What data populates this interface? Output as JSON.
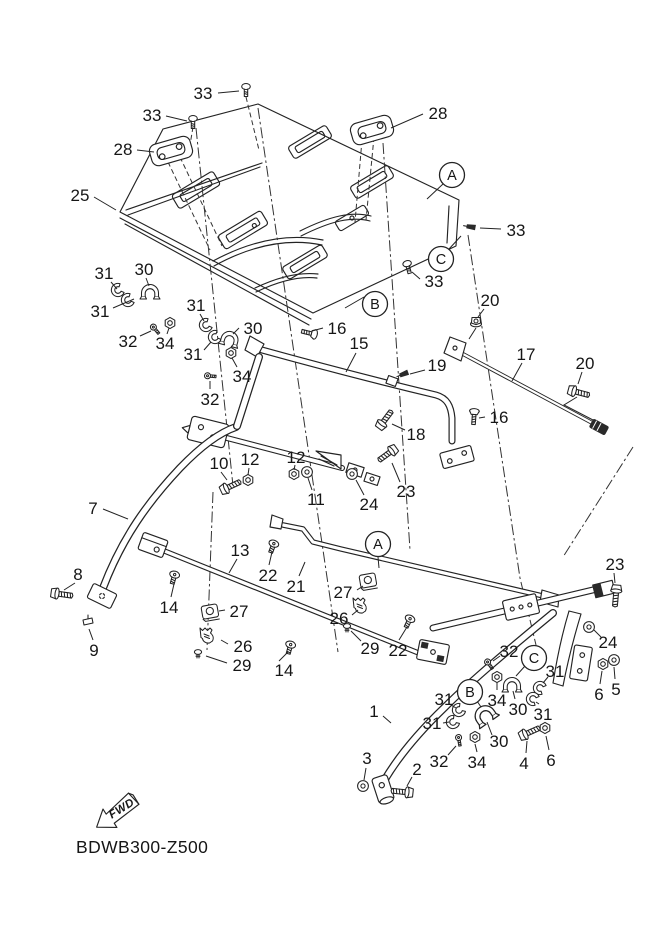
{
  "meta": {
    "code": "BDWB300-Z500",
    "fwd_label": "FWD"
  },
  "colors": {
    "line": "#232323",
    "background": "#ffffff"
  },
  "labels": [
    {
      "t": "33",
      "x": 203,
      "y": 93,
      "l": [
        218,
        93,
        239,
        91
      ]
    },
    {
      "t": "33",
      "x": 152,
      "y": 115,
      "l": [
        166,
        116,
        187,
        121
      ]
    },
    {
      "t": "28",
      "x": 123,
      "y": 149,
      "l": [
        137,
        150,
        154,
        152
      ]
    },
    {
      "t": "25",
      "x": 80,
      "y": 195,
      "l": [
        94,
        197,
        116,
        210
      ]
    },
    {
      "t": "28",
      "x": 438,
      "y": 113,
      "l": [
        423,
        114,
        391,
        128
      ]
    },
    {
      "t": "A",
      "x": 452,
      "y": 175,
      "c": true,
      "l": [
        443,
        184,
        427,
        199
      ]
    },
    {
      "t": "33",
      "x": 516,
      "y": 230,
      "l": [
        501,
        229,
        480,
        228
      ]
    },
    {
      "t": "C",
      "x": 441,
      "y": 259,
      "c": true,
      "l": [
        449,
        249,
        461,
        236
      ]
    },
    {
      "t": "33",
      "x": 434,
      "y": 281,
      "l": [
        420,
        279,
        412,
        272
      ]
    },
    {
      "t": "B",
      "x": 375,
      "y": 304,
      "c": true,
      "l": [
        364,
        297,
        345,
        308
      ]
    },
    {
      "t": "20",
      "x": 490,
      "y": 300,
      "l": [
        484,
        309,
        478,
        317
      ]
    },
    {
      "t": "16",
      "x": 337,
      "y": 328,
      "l": [
        323,
        328,
        312,
        331
      ]
    },
    {
      "t": "15",
      "x": 359,
      "y": 343,
      "l": [
        356,
        353,
        346,
        372
      ]
    },
    {
      "t": "17",
      "x": 526,
      "y": 354,
      "l": [
        522,
        363,
        512,
        381
      ]
    },
    {
      "t": "20",
      "x": 585,
      "y": 363,
      "l": [
        582,
        372,
        578,
        384
      ]
    },
    {
      "t": "19",
      "x": 437,
      "y": 365,
      "l": [
        425,
        370,
        410,
        374
      ]
    },
    {
      "t": "18",
      "x": 416,
      "y": 434,
      "l": [
        405,
        430,
        392,
        424
      ]
    },
    {
      "t": "16",
      "x": 499,
      "y": 417,
      "l": [
        485,
        417,
        479,
        418
      ]
    },
    {
      "t": "31",
      "x": 104,
      "y": 273,
      "l": [
        111,
        282,
        117,
        289
      ]
    },
    {
      "t": "30",
      "x": 144,
      "y": 269,
      "l": [
        146,
        278,
        149,
        286
      ]
    },
    {
      "t": "31",
      "x": 100,
      "y": 311,
      "l": [
        113,
        308,
        134,
        299
      ]
    },
    {
      "t": "32",
      "x": 128,
      "y": 341,
      "l": [
        140,
        336,
        151,
        331
      ]
    },
    {
      "t": "34",
      "x": 165,
      "y": 343,
      "l": [
        167,
        334,
        169,
        328
      ]
    },
    {
      "t": "31",
      "x": 196,
      "y": 305,
      "l": [
        200,
        314,
        204,
        321
      ]
    },
    {
      "t": "30",
      "x": 253,
      "y": 328,
      "l": [
        239,
        328,
        233,
        334
      ]
    },
    {
      "t": "31",
      "x": 193,
      "y": 354,
      "l": [
        204,
        350,
        211,
        342
      ]
    },
    {
      "t": "34",
      "x": 242,
      "y": 376,
      "l": [
        237,
        367,
        232,
        358
      ]
    },
    {
      "t": "32",
      "x": 210,
      "y": 399,
      "l": [
        210,
        389,
        210,
        381
      ]
    },
    {
      "t": "10",
      "x": 219,
      "y": 463,
      "l": [
        221,
        472,
        227,
        480
      ]
    },
    {
      "t": "12",
      "x": 250,
      "y": 459,
      "l": [
        249,
        468,
        248,
        475
      ]
    },
    {
      "t": "12",
      "x": 296,
      "y": 457,
      "l": [
        295,
        465,
        294,
        470
      ]
    },
    {
      "t": "11",
      "x": 316,
      "y": 499,
      "l": [
        312,
        490,
        308,
        478
      ]
    },
    {
      "t": "24",
      "x": 369,
      "y": 504,
      "l": [
        364,
        495,
        356,
        480
      ]
    },
    {
      "t": "23",
      "x": 406,
      "y": 491,
      "l": [
        400,
        482,
        392,
        463
      ]
    },
    {
      "t": "7",
      "x": 93,
      "y": 508,
      "l": [
        103,
        509,
        128,
        519
      ]
    },
    {
      "t": "8",
      "x": 78,
      "y": 574,
      "l": [
        75,
        583,
        64,
        590
      ]
    },
    {
      "t": "9",
      "x": 94,
      "y": 650,
      "l": [
        93,
        640,
        89,
        629
      ]
    },
    {
      "t": "13",
      "x": 240,
      "y": 550,
      "l": [
        237,
        559,
        229,
        573
      ]
    },
    {
      "t": "22",
      "x": 268,
      "y": 575,
      "l": [
        269,
        565,
        272,
        552
      ]
    },
    {
      "t": "14",
      "x": 169,
      "y": 607,
      "l": [
        171,
        597,
        174,
        584
      ]
    },
    {
      "t": "27",
      "x": 239,
      "y": 611,
      "l": [
        225,
        610,
        219,
        611
      ]
    },
    {
      "t": "26",
      "x": 243,
      "y": 646,
      "l": [
        228,
        644,
        221,
        640
      ]
    },
    {
      "t": "29",
      "x": 242,
      "y": 665,
      "l": [
        227,
        663,
        206,
        656
      ]
    },
    {
      "t": "21",
      "x": 296,
      "y": 586,
      "l": [
        299,
        576,
        305,
        562
      ]
    },
    {
      "t": "A",
      "x": 378,
      "y": 544,
      "c": true,
      "l": [
        378,
        557,
        379,
        568
      ]
    },
    {
      "t": "27",
      "x": 343,
      "y": 592,
      "l": [
        357,
        590,
        363,
        586
      ]
    },
    {
      "t": "26",
      "x": 339,
      "y": 618,
      "l": [
        352,
        615,
        358,
        610
      ]
    },
    {
      "t": "29",
      "x": 370,
      "y": 648,
      "l": [
        361,
        641,
        351,
        631
      ]
    },
    {
      "t": "22",
      "x": 398,
      "y": 650,
      "l": [
        399,
        640,
        407,
        627
      ]
    },
    {
      "t": "14",
      "x": 284,
      "y": 670,
      "l": [
        279,
        661,
        288,
        652
      ]
    },
    {
      "t": "23",
      "x": 615,
      "y": 564,
      "l": [
        614,
        573,
        615,
        583
      ]
    },
    {
      "t": "24",
      "x": 608,
      "y": 642,
      "l": [
        601,
        637,
        594,
        630
      ]
    },
    {
      "t": "32",
      "x": 509,
      "y": 651,
      "l": [
        500,
        656,
        493,
        661
      ]
    },
    {
      "t": "C",
      "x": 534,
      "y": 658,
      "c": true,
      "l": [
        525,
        666,
        516,
        676
      ]
    },
    {
      "t": "31",
      "x": 555,
      "y": 671,
      "l": [
        548,
        677,
        543,
        683
      ]
    },
    {
      "t": "34",
      "x": 497,
      "y": 700,
      "l": [
        497,
        690,
        497,
        683
      ]
    },
    {
      "t": "30",
      "x": 518,
      "y": 709,
      "l": [
        515,
        699,
        513,
        691
      ]
    },
    {
      "t": "31",
      "x": 543,
      "y": 714,
      "l": [
        539,
        704,
        536,
        702
      ]
    },
    {
      "t": "6",
      "x": 599,
      "y": 694,
      "l": [
        600,
        684,
        602,
        671
      ]
    },
    {
      "t": "5",
      "x": 616,
      "y": 689,
      "l": [
        615,
        679,
        614,
        667
      ]
    },
    {
      "t": "B",
      "x": 470,
      "y": 692,
      "c": true,
      "l": [
        477,
        701,
        481,
        707
      ]
    },
    {
      "t": "31",
      "x": 444,
      "y": 699,
      "l": [
        451,
        705,
        456,
        708
      ]
    },
    {
      "t": "1",
      "x": 374,
      "y": 711,
      "l": [
        383,
        716,
        391,
        723
      ]
    },
    {
      "t": "31",
      "x": 432,
      "y": 723,
      "l": [
        443,
        723,
        449,
        722
      ]
    },
    {
      "t": "30",
      "x": 499,
      "y": 741,
      "l": [
        492,
        735,
        487,
        722
      ]
    },
    {
      "t": "32",
      "x": 439,
      "y": 761,
      "l": [
        448,
        755,
        456,
        746
      ]
    },
    {
      "t": "34",
      "x": 477,
      "y": 762,
      "l": [
        477,
        752,
        475,
        744
      ]
    },
    {
      "t": "4",
      "x": 524,
      "y": 763,
      "l": [
        526,
        753,
        527,
        741
      ]
    },
    {
      "t": "6",
      "x": 551,
      "y": 760,
      "l": [
        549,
        750,
        546,
        736
      ]
    },
    {
      "t": "3",
      "x": 367,
      "y": 758,
      "l": [
        366,
        768,
        364,
        780
      ]
    },
    {
      "t": "2",
      "x": 417,
      "y": 769,
      "l": [
        412,
        777,
        407,
        786
      ]
    }
  ],
  "hardware": [
    {
      "n": "pan-screw",
      "x": 246,
      "y": 90,
      "r": 0
    },
    {
      "n": "pan-screw",
      "x": 193,
      "y": 122,
      "r": 0
    },
    {
      "n": "pan-screw",
      "x": 408,
      "y": 267,
      "r": -15
    },
    {
      "n": "wedge-clip",
      "x": 471,
      "y": 227,
      "r": 10
    },
    {
      "n": "wedge-clip",
      "x": 404,
      "y": 374,
      "r": -20
    },
    {
      "n": "flange-nut",
      "x": 476,
      "y": 322,
      "r": 0
    },
    {
      "n": "hex-bolt",
      "x": 577,
      "y": 392,
      "r": 15
    },
    {
      "n": "flat-screw",
      "x": 309,
      "y": 333,
      "r": 194
    },
    {
      "n": "flat-screw",
      "x": 474,
      "y": 417,
      "r": 94
    },
    {
      "n": "hex-bolt",
      "x": 384,
      "y": 421,
      "r": -53
    },
    {
      "n": "hex-bolt",
      "x": 229,
      "y": 487,
      "r": -25
    },
    {
      "n": "hex-bolt",
      "x": 389,
      "y": 453,
      "r": 144
    },
    {
      "n": "hex-nut",
      "x": 248,
      "y": 480,
      "r": 0
    },
    {
      "n": "hex-nut",
      "x": 294,
      "y": 474,
      "r": 0
    },
    {
      "n": "washer",
      "x": 307,
      "y": 472,
      "r": 0
    },
    {
      "n": "washer",
      "x": 352,
      "y": 474,
      "r": 0
    },
    {
      "n": "bushing",
      "x": 118,
      "y": 290,
      "r": -25
    },
    {
      "n": "bushing",
      "x": 128,
      "y": 300,
      "r": -25
    },
    {
      "n": "clamp",
      "x": 150,
      "y": 291,
      "r": 0
    },
    {
      "n": "small-screw",
      "x": 155,
      "y": 329,
      "r": -40
    },
    {
      "n": "hex-nut",
      "x": 170,
      "y": 323,
      "r": 0
    },
    {
      "n": "bushing",
      "x": 206,
      "y": 325,
      "r": -25
    },
    {
      "n": "bushing",
      "x": 215,
      "y": 337,
      "r": -25
    },
    {
      "n": "clamp",
      "x": 230,
      "y": 338,
      "r": 15
    },
    {
      "n": "hex-nut",
      "x": 231,
      "y": 353,
      "r": 0
    },
    {
      "n": "small-screw",
      "x": 210,
      "y": 376,
      "r": -85
    },
    {
      "n": "hex-bolt",
      "x": 60,
      "y": 594,
      "r": 8
    },
    {
      "n": "foot-clip",
      "x": 88,
      "y": 622,
      "r": 0
    },
    {
      "n": "pan-screw-down",
      "x": 174,
      "y": 577,
      "r": 15
    },
    {
      "n": "pan-screw-down",
      "x": 290,
      "y": 647,
      "r": 15
    },
    {
      "n": "pan-screw-down",
      "x": 273,
      "y": 546,
      "r": 20
    },
    {
      "n": "pan-screw-down",
      "x": 409,
      "y": 621,
      "r": 25
    },
    {
      "n": "rubber-mount",
      "x": 210,
      "y": 612,
      "r": -10
    },
    {
      "n": "serrated-clamp",
      "x": 209,
      "y": 634,
      "r": 0
    },
    {
      "n": "push-rivet",
      "x": 198,
      "y": 652,
      "r": 0
    },
    {
      "n": "rubber-mount",
      "x": 368,
      "y": 581,
      "r": -10
    },
    {
      "n": "serrated-clamp",
      "x": 362,
      "y": 604,
      "r": 0
    },
    {
      "n": "push-rivet",
      "x": 347,
      "y": 626,
      "r": 0
    },
    {
      "n": "hex-bolt",
      "x": 616,
      "y": 594,
      "r": 95
    },
    {
      "n": "washer",
      "x": 589,
      "y": 627,
      "r": 0
    },
    {
      "n": "hex-nut",
      "x": 603,
      "y": 664,
      "r": 0
    },
    {
      "n": "washer",
      "x": 614,
      "y": 660,
      "r": 0
    },
    {
      "n": "small-screw",
      "x": 489,
      "y": 664,
      "r": -35
    },
    {
      "n": "hex-nut",
      "x": 497,
      "y": 677,
      "r": 0
    },
    {
      "n": "clamp",
      "x": 512,
      "y": 684,
      "r": 0
    },
    {
      "n": "bushing",
      "x": 540,
      "y": 688,
      "r": 25
    },
    {
      "n": "bushing",
      "x": 533,
      "y": 699,
      "r": 25
    },
    {
      "n": "bushing",
      "x": 459,
      "y": 710,
      "r": -35
    },
    {
      "n": "bushing",
      "x": 453,
      "y": 722,
      "r": -35
    },
    {
      "n": "clamp",
      "x": 484,
      "y": 714,
      "r": -35,
      "s": 1.2
    },
    {
      "n": "small-screw",
      "x": 459,
      "y": 740,
      "r": -10
    },
    {
      "n": "hex-nut",
      "x": 475,
      "y": 737,
      "r": 0
    },
    {
      "n": "hex-bolt",
      "x": 528,
      "y": 733,
      "r": -24
    },
    {
      "n": "hex-nut",
      "x": 545,
      "y": 728,
      "r": 0
    },
    {
      "n": "washer",
      "x": 363,
      "y": 786,
      "r": 0
    },
    {
      "n": "hex-bolt",
      "x": 404,
      "y": 792,
      "r": 186
    }
  ]
}
